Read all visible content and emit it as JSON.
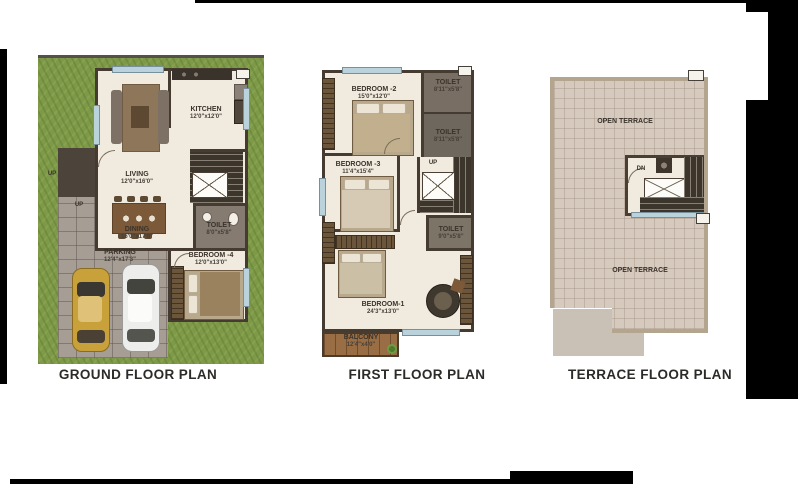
{
  "image": {
    "type": "residential floor plan sheet",
    "background": "#ffffff"
  },
  "colors": {
    "lawn": "#7e9a48",
    "floor_cream": "#f1ebdf",
    "wall_dark": "#453b30",
    "terrace_tile": "#d6cabf",
    "paver_gray": "#a69d94",
    "balcony_wood": "#9a6e45",
    "window_blue": "#b9d2dc",
    "car_gold": "#c9a13b",
    "car_white": "#ededeb"
  },
  "plans": {
    "ground": {
      "title": "GROUND FLOOR PLAN",
      "up1": "UP",
      "up2": "UP",
      "kitchen": {
        "name": "KITCHEN",
        "dims": "12'0\"x12'0\""
      },
      "living": {
        "name": "LIVING",
        "dims": "12'0\"x16'0\""
      },
      "dining": {
        "name": "DINING",
        "dims": "16'0\"x17'8\""
      },
      "toilet": {
        "name": "TOILET",
        "dims": "8'0\"x5'8\""
      },
      "parking": {
        "name": "PARKING",
        "dims": "12'4\"x17'3\""
      },
      "bedroom4": {
        "name": "BEDROOM -4",
        "dims": "12'0\"x13'0\""
      }
    },
    "first": {
      "title": "FIRST FLOOR PLAN",
      "up": "UP",
      "bedroom2": {
        "name": "BEDROOM -2",
        "dims": "15'0\"x12'0\""
      },
      "toilet_a": {
        "name": "TOILET",
        "dims": "8'11\"x5'8\""
      },
      "toilet_b": {
        "name": "TOILET",
        "dims": "8'11\"x5'8\""
      },
      "bedroom3": {
        "name": "BEDROOM -3",
        "dims": "11'4\"x15'4\""
      },
      "toilet_c": {
        "name": "TOILET",
        "dims": "9'0\"x5'8\""
      },
      "bedroom1": {
        "name": "BEDROOM-1",
        "dims": "24'3\"x13'0\""
      },
      "balcony": {
        "name": "BALCONY",
        "dims": "12'4\"x4'0\""
      }
    },
    "terrace": {
      "title": "TERRACE FLOOR PLAN",
      "dn": "DN",
      "open_terrace_top": "OPEN TERRACE",
      "open_terrace_bottom": "OPEN TERRACE"
    }
  }
}
